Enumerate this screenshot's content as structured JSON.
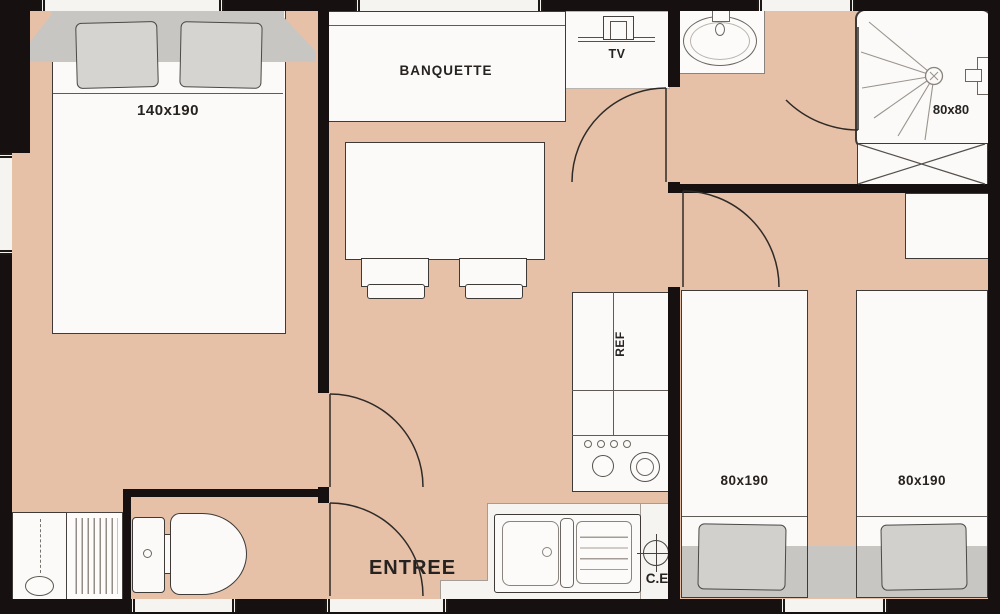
{
  "plan_title": "mobile-home floor plan",
  "labels": {
    "double_bed": "140x190",
    "banquette": "BANQUETTE",
    "tv": "TV",
    "shower": "80x80",
    "fridge": "REF",
    "single_bed_left": "80x190",
    "single_bed_right": "80x190",
    "entrance": "ENTREE",
    "water_heater": "C.E"
  },
  "colors": {
    "floor": "#e6c1a8",
    "walls": "#161110",
    "furniture_fill": "#fbfaf8",
    "headboard_gray": "#c8c6c3",
    "outline": "#3d3a38",
    "text": "#262220"
  }
}
